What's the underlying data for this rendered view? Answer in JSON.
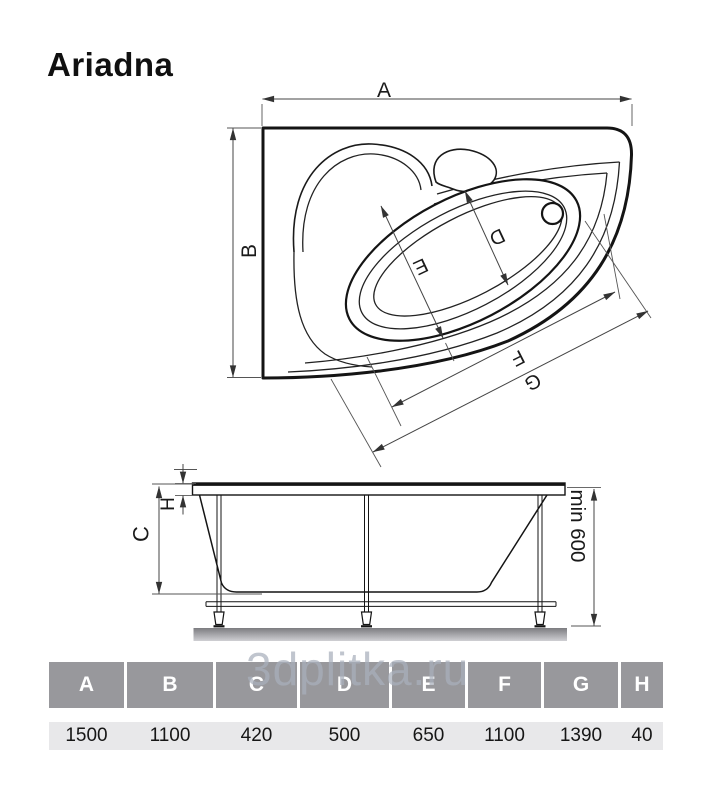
{
  "title": "Ariadna",
  "watermark": "3dplitka.ru",
  "top_view": {
    "dim_a": "A",
    "dim_b": "B",
    "dim_d": "D",
    "dim_e": "E",
    "dim_f": "F",
    "dim_g": "G"
  },
  "side_view": {
    "dim_c": "C",
    "dim_h": "H",
    "min_height": "min 600"
  },
  "table": {
    "headers": [
      "A",
      "B",
      "C",
      "D",
      "E",
      "F",
      "G",
      "H"
    ],
    "values": [
      "1500",
      "1100",
      "420",
      "500",
      "650",
      "1100",
      "1390",
      "40"
    ]
  },
  "colors": {
    "outline": "#141414",
    "dimension_line": "#444444",
    "table_header_bg": "#98989c",
    "table_header_text": "#ffffff",
    "table_value_bg": "#e8e8ea",
    "watermark": "#a9b0bc",
    "ground_top": "#7c7c80",
    "ground_bottom": "#cfcfd3"
  }
}
